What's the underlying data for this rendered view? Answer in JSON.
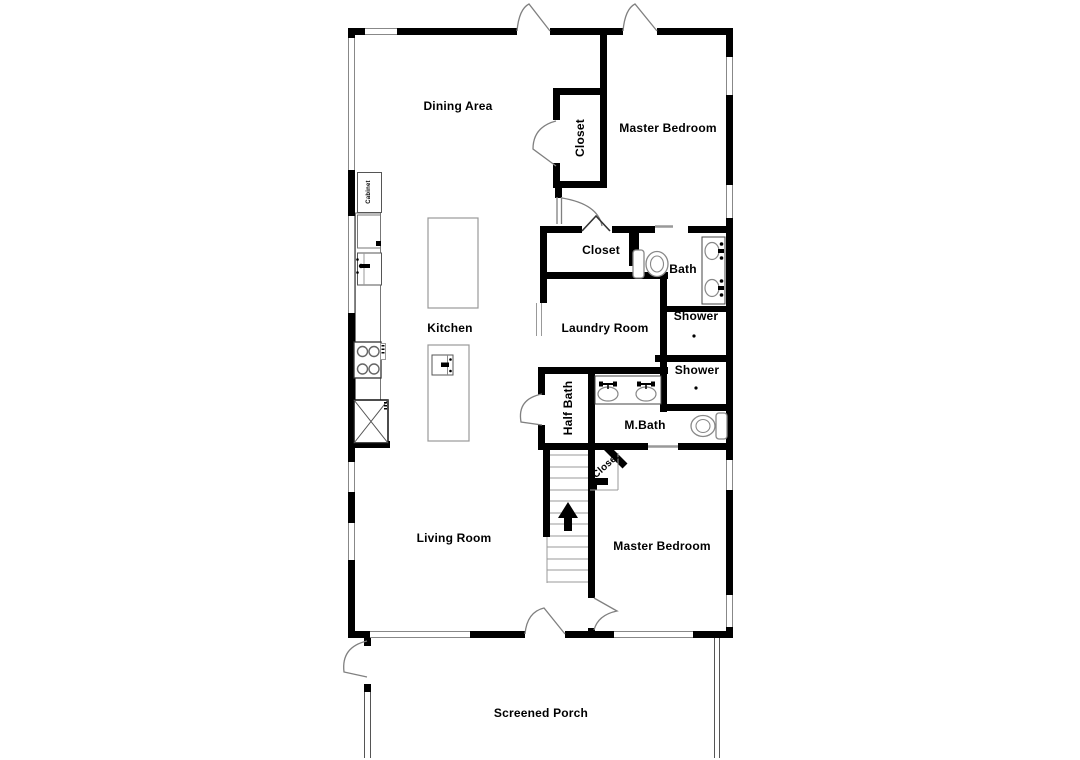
{
  "plan": {
    "title": "Residential floor plan",
    "colors": {
      "wall": "#000000",
      "door_line": "#808080",
      "window_line": "#888888",
      "fixture_outline": "#888888",
      "text": "#000000",
      "background": "#ffffff"
    },
    "rooms": {
      "dining": {
        "label": "Dining Area"
      },
      "master_bedroom_top": {
        "label": "Master Bedroom"
      },
      "closet_top": {
        "label": "Closet"
      },
      "kitchen": {
        "label": "Kitchen"
      },
      "closet_hall": {
        "label": "Closet"
      },
      "bath": {
        "label": "Bath"
      },
      "laundry": {
        "label": "Laundry Room"
      },
      "shower_upper": {
        "label": "Shower"
      },
      "shower_lower": {
        "label": "Shower"
      },
      "half_bath": {
        "label": "Half Bath"
      },
      "master_bath": {
        "label": "M.Bath"
      },
      "closet_understairs": {
        "label": "Closet"
      },
      "living": {
        "label": "Living Room"
      },
      "master_bedroom_bottom": {
        "label": "Master Bedroom"
      },
      "screened_porch": {
        "label": "Screened Porch"
      }
    },
    "fixtures": {
      "cabinet": {
        "label": "Cabinet"
      }
    }
  }
}
